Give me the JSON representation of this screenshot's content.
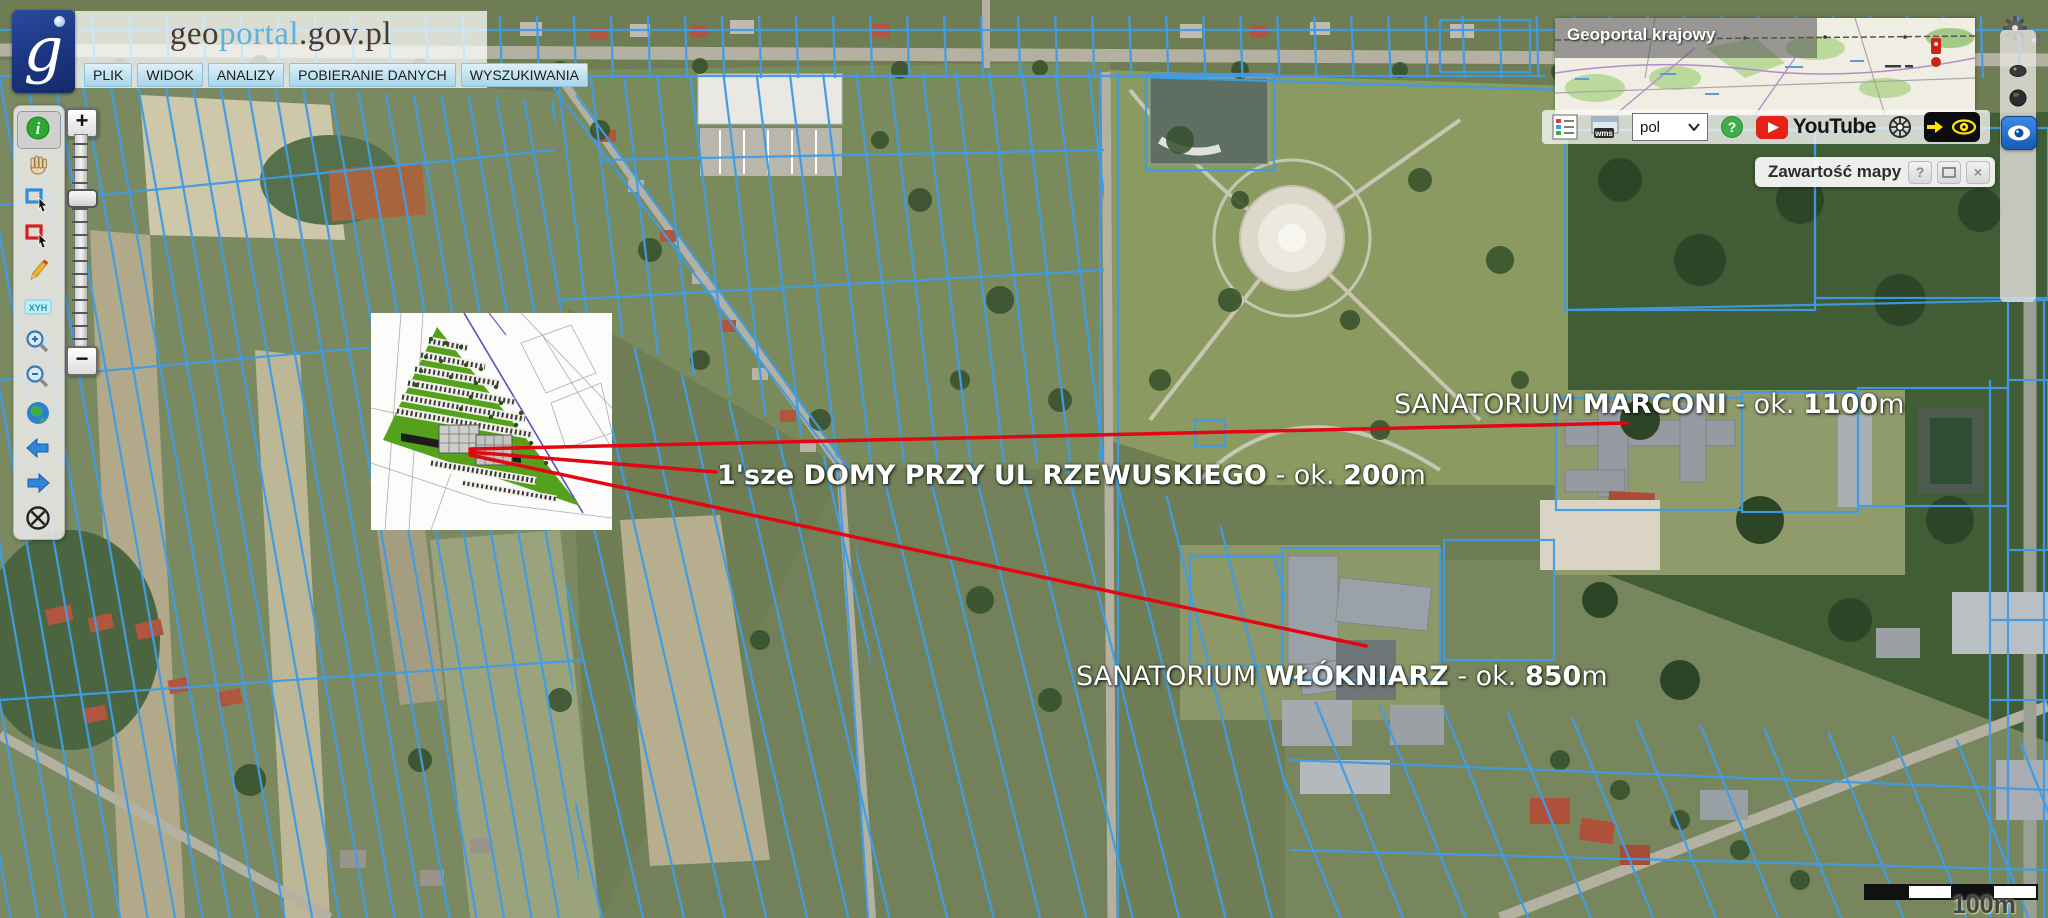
{
  "header": {
    "logo_glyph": "g",
    "title": {
      "geo": "geo",
      "portal": "portal",
      "suffix": ".gov.pl"
    },
    "menu": [
      {
        "label": "PLIK"
      },
      {
        "label": "WIDOK"
      },
      {
        "label": "ANALIZY"
      },
      {
        "label": "POBIERANIE DANYCH"
      },
      {
        "label": "WYSZUKIWANIA"
      }
    ]
  },
  "left_toolbar": {
    "info_glyph": "i",
    "xyh_label": "XYH"
  },
  "zoom_slider": {
    "plus": "+",
    "minus": "−"
  },
  "overview_map": {
    "title": "Geoportal krajowy"
  },
  "top_right": {
    "wms_label": "wms",
    "language_value": "pol",
    "help_glyph": "?",
    "youtube_label": "YouTube"
  },
  "layers_panel": {
    "title": "Zawartość mapy",
    "help": "?",
    "close": "×"
  },
  "annotations": [
    {
      "prefix": "SANATORIUM ",
      "name": "MARCONI",
      "separator": " - ok. ",
      "distance": "1100",
      "unit": "m"
    },
    {
      "prefix": "",
      "name": "1'sze DOMY PRZY UL RZEWUSKIEGO",
      "separator": " - ok. ",
      "distance": "200",
      "unit": "m"
    },
    {
      "prefix": "SANATORIUM ",
      "name": "WŁÓKNIARZ",
      "separator": " - ok. ",
      "distance": "850",
      "unit": "m"
    }
  ],
  "scale_bar": {
    "label": "100m"
  },
  "colors": {
    "annotation_line_red": "#e30613",
    "parcel_blue": "#3f9ce6",
    "panel_blue_button": "#175bb4",
    "contrast_yellow": "#ffe600",
    "logo_blue": "#1b3580"
  }
}
